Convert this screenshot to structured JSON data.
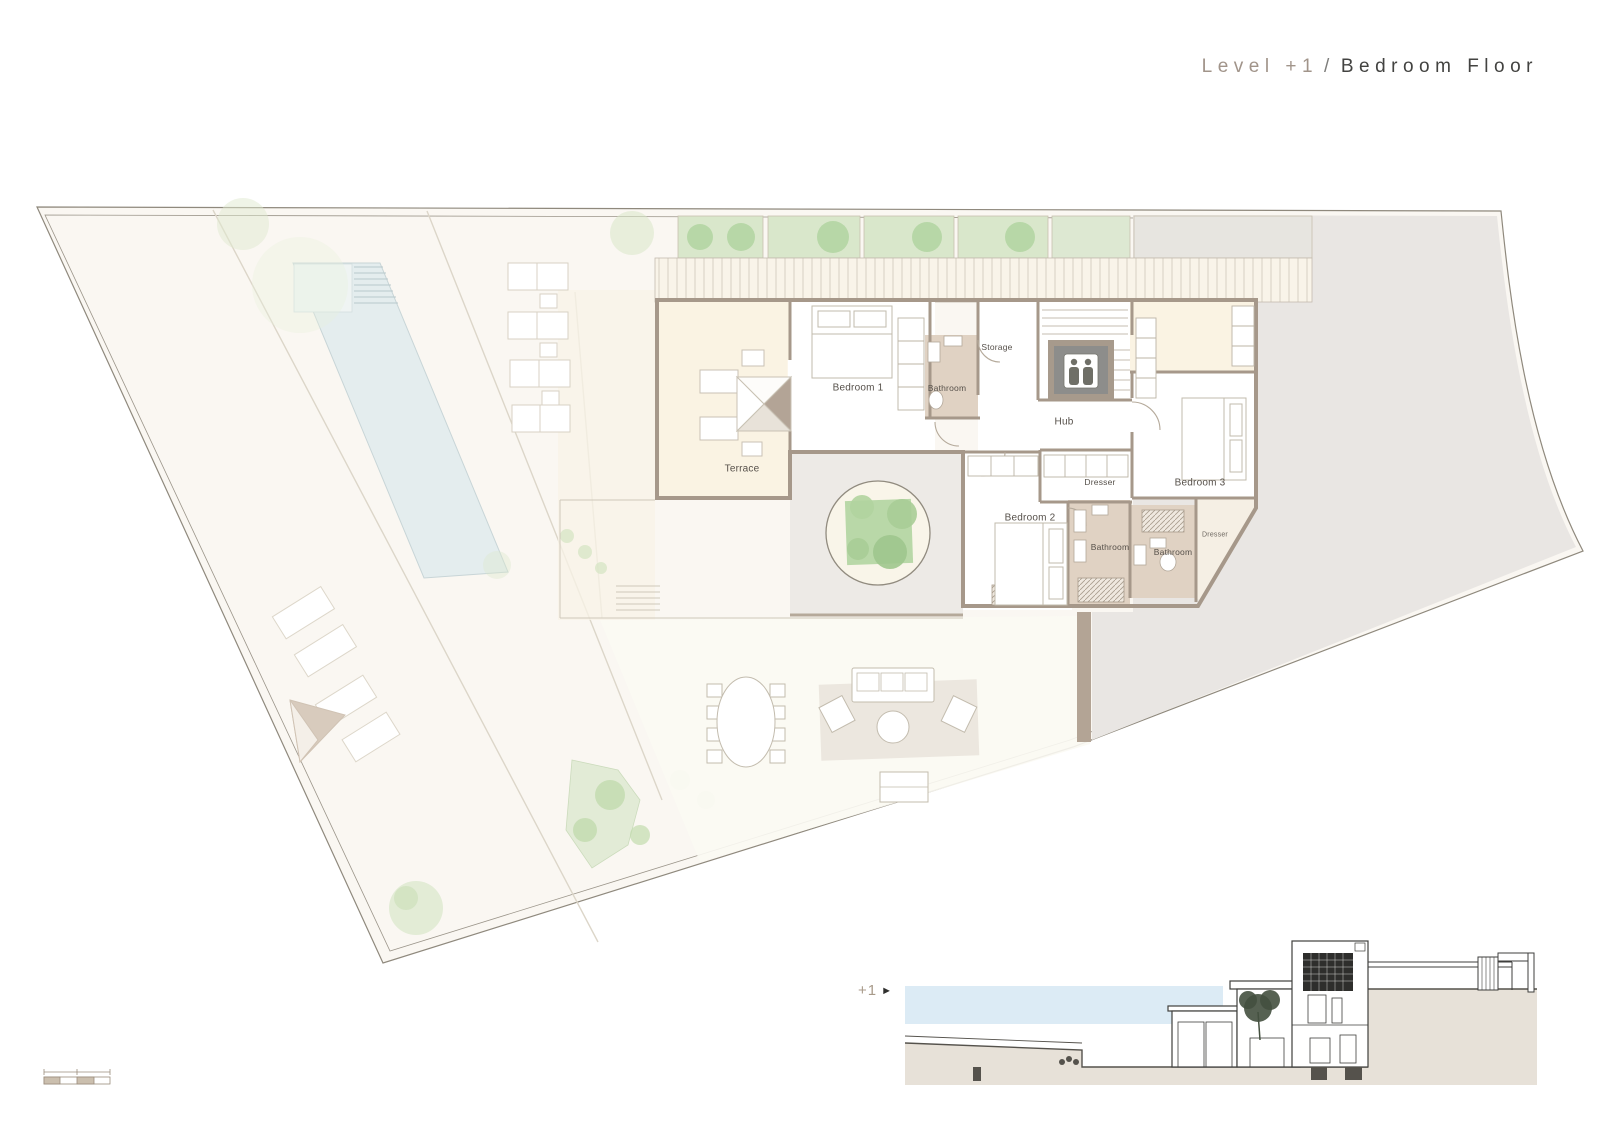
{
  "title": {
    "level": "Level +1",
    "separator": "/",
    "floor_name": "Bedroom Floor"
  },
  "plan_labels": {
    "terrace": "Terrace",
    "bedroom1": "Bedroom 1",
    "bathroom1": "Bathroom",
    "storage": "Storage",
    "hub": "Hub",
    "dresser1": "Dresser",
    "bedroom2": "Bedroom 2",
    "bathroom2": "Bathroom",
    "bathroom3": "Bathroom",
    "dresser2": "Dresser",
    "bedroom3": "Bedroom 3"
  },
  "section": {
    "level_marker": "+1",
    "arrow": "►"
  },
  "colors": {
    "accent_taupe": "#a1948a",
    "text_dark": "#434341",
    "wall": "#a6988a",
    "bathroom_floor": "#e0d2c3",
    "cream": "#faf3e3",
    "pool_blue": "#e4edee",
    "terrain_gray": "#e9e6e3",
    "planter_green": "#d9e7cb",
    "section_blue": "#dcebf5"
  }
}
